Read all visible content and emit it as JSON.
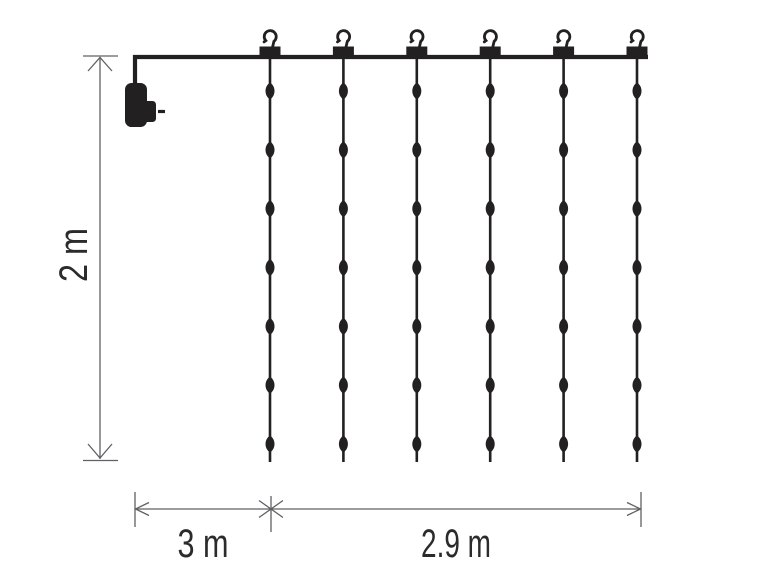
{
  "page": {
    "title": "Light curtain dimension diagram"
  },
  "diagram": {
    "labels": {
      "height": "2 m",
      "lead": "3 m",
      "width": "2.9 m"
    },
    "curtain": {
      "strand_count": 6,
      "hook_count": 6,
      "leds_per_strand": 7
    },
    "colors": {
      "ink": "#232021",
      "dimension_line": "#606164",
      "label_text": "#2b2b2b",
      "background": "#ffffff"
    }
  }
}
